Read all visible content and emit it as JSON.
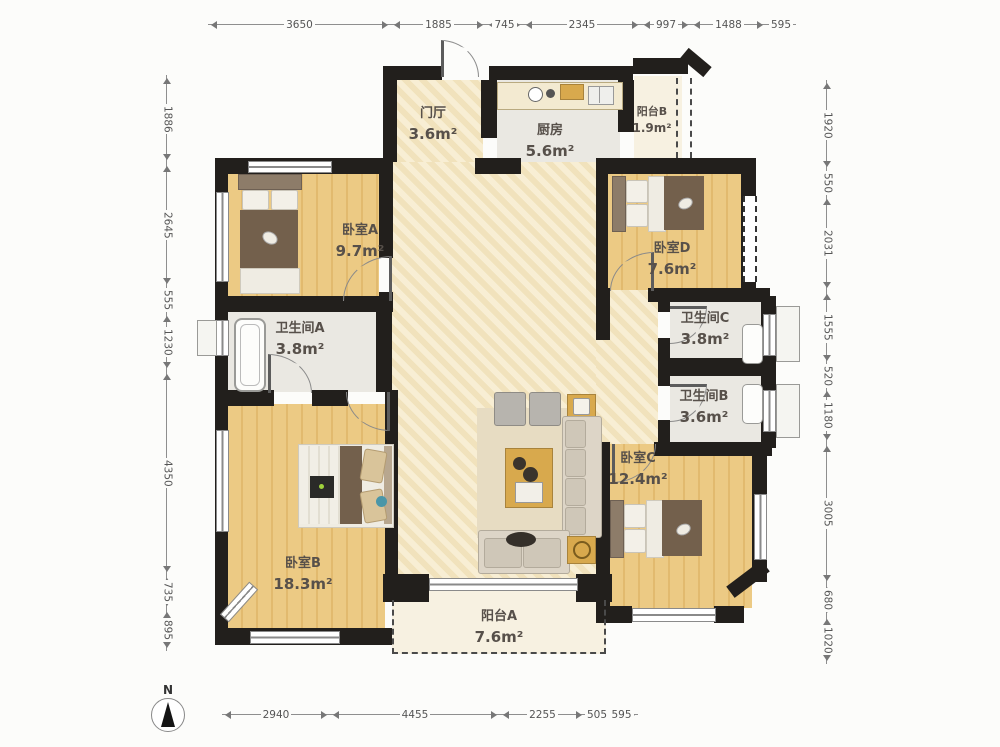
{
  "meta": {
    "north_label": "N"
  },
  "rooms": [
    {
      "id": "entry-hall",
      "label": "门厅",
      "area": "3.6m²"
    },
    {
      "id": "kitchen",
      "label": "厨房",
      "area": "5.6m²"
    },
    {
      "id": "balcony-b",
      "label": "阳台B",
      "area": "1.9m²"
    },
    {
      "id": "bedroom-a",
      "label": "卧室A",
      "area": "9.7m²"
    },
    {
      "id": "bedroom-d",
      "label": "卧室D",
      "area": "7.6m²"
    },
    {
      "id": "bathroom-a",
      "label": "卫生间A",
      "area": "3.8m²"
    },
    {
      "id": "bathroom-c",
      "label": "卫生间C",
      "area": "3.8m²"
    },
    {
      "id": "bathroom-b",
      "label": "卫生间B",
      "area": "3.6m²"
    },
    {
      "id": "bedroom-c",
      "label": "卧室C",
      "area": "12.4m²"
    },
    {
      "id": "bedroom-b",
      "label": "卧室B",
      "area": "18.3m²"
    },
    {
      "id": "balcony-a",
      "label": "阳台A",
      "area": "7.6m²"
    }
  ],
  "dimensions": {
    "top": [
      "3650",
      "1885",
      "745",
      "2345",
      "997",
      "1488",
      "595"
    ],
    "bottom": [
      "2940",
      "4455",
      "2255",
      "505",
      "595"
    ],
    "left": [
      "1886",
      "2645",
      "555",
      "1230",
      "4350",
      "735",
      "895"
    ],
    "right": [
      "1920",
      "550",
      "2031",
      "1555",
      "520",
      "1180",
      "3005",
      "680",
      "1020"
    ]
  },
  "colors": {
    "wall": "#221f1c",
    "wood_floor": "#ecca84",
    "living_floor": "#f5e9c6",
    "tile_floor": "#eae8e2",
    "accent_gold": "#d8a94d"
  }
}
